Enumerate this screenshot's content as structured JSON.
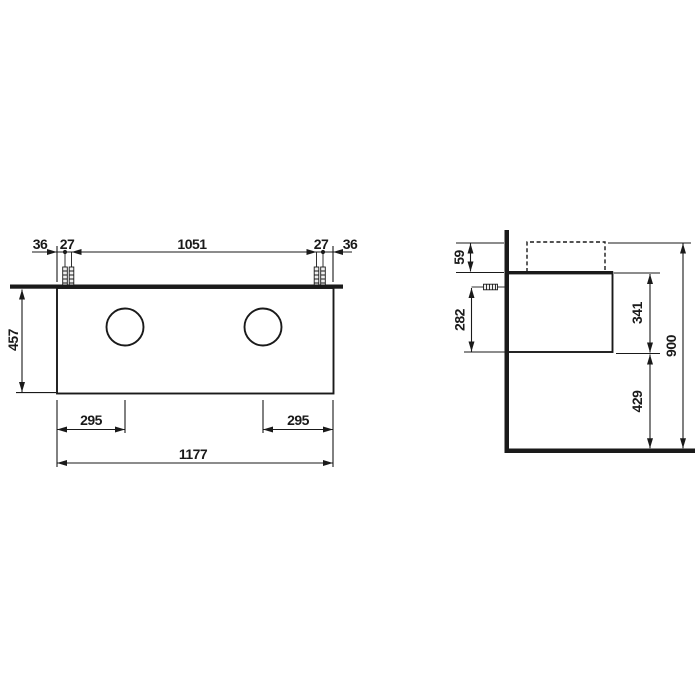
{
  "colors": {
    "line": "#1a1a1a",
    "background": "#ffffff"
  },
  "front_view": {
    "top_dimension_chain": [
      "36",
      "27",
      "1051",
      "27",
      "36"
    ],
    "height": "457",
    "drain_offset_left": "295",
    "drain_offset_right": "295",
    "total_width": "1177"
  },
  "side_view": {
    "countertop_overhang": "59",
    "mount_screw_height": "282",
    "cabinet_height": "341",
    "clearance_below": "429",
    "total_height": "900"
  }
}
